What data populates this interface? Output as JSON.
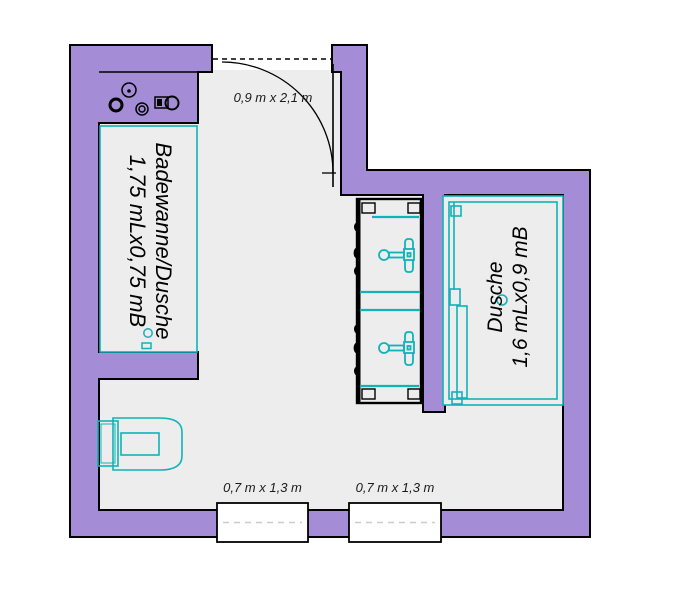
{
  "plan": {
    "door": {
      "label": "0,9 m x 2,1 m"
    },
    "windows": [
      {
        "label": "0,7 m x 1,3 m"
      },
      {
        "label": "0,7 m x 1,3 m"
      }
    ],
    "bathtub": {
      "name": "Badewanne/Dusche",
      "size": "1,75 mLx0,75 mB"
    },
    "shower": {
      "name": "Dusche",
      "size": "1,6 mLx0,9 mB"
    }
  },
  "colors": {
    "wall_fill": "#a58cd7",
    "wall_outline": "#000000",
    "floor": "#ededed",
    "fixture": "#0fb3b8",
    "window_dash": "#cccccc",
    "background": "#ffffff",
    "label_text": "#1a1a1a"
  }
}
